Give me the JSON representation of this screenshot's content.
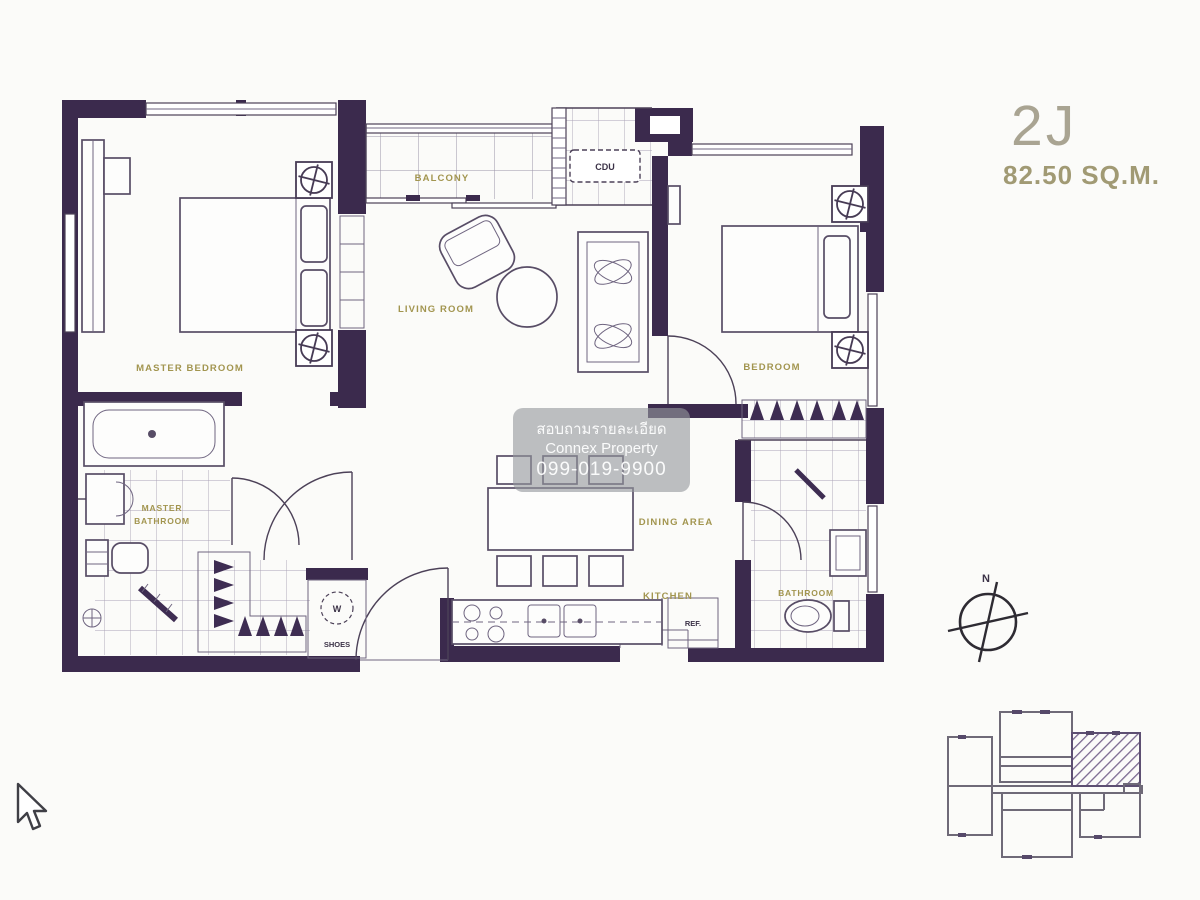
{
  "title": {
    "unit": "2J",
    "area": "82.50 SQ.M."
  },
  "rooms": {
    "master_bedroom": "MASTER BEDROOM",
    "balcony": "BALCONY",
    "living_room": "LIVING ROOM",
    "bedroom": "BEDROOM",
    "master_bathroom_1": "MASTER",
    "master_bathroom_2": "BATHROOM",
    "dining_area": "DINING AREA",
    "kitchen": "KITCHEN",
    "bathroom": "BATHROOM"
  },
  "fixtures": {
    "cdu": "CDU",
    "ref": "REF.",
    "shoes": "SHOES",
    "washer": "W"
  },
  "watermark": {
    "line1": "สอบถามรายละเอียด",
    "line2": "Connex Property",
    "line3": "099-019-9900"
  },
  "compass": {
    "north": "N"
  },
  "colors": {
    "wall": "#3b2a4d",
    "line": "#4c4158",
    "label": "#a2954f",
    "title": "#a9a492",
    "title2": "#a19a74",
    "watermark_bg": "rgba(148,152,157,0.62)",
    "hatch": "#7a6890"
  }
}
